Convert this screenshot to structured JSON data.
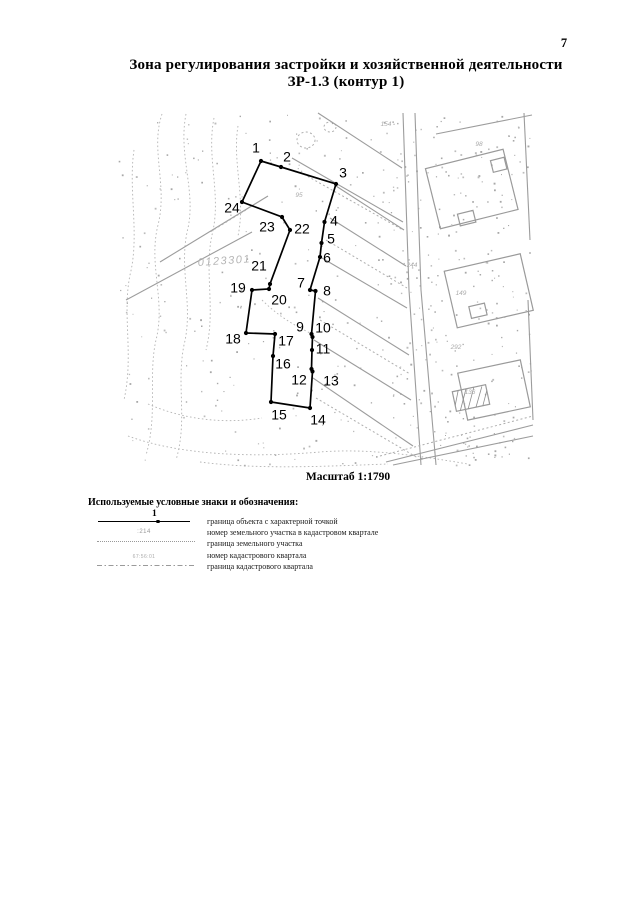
{
  "page": {
    "number": "7"
  },
  "title": {
    "line1": "Зона регулирования застройки и хозяйственной деятельности",
    "line2": "ЗР-1.3 (контур 1)"
  },
  "map": {
    "scale_caption": "Масштаб 1:1790",
    "cadastral_quarter_label": "0123301",
    "boundary_color": "#000000",
    "detail_color": "#a8a8a8",
    "points": [
      {
        "n": "1",
        "x": 261,
        "y": 161,
        "lx": 256,
        "ly": 148
      },
      {
        "n": "2",
        "x": 281,
        "y": 167,
        "lx": 287,
        "ly": 157
      },
      {
        "n": "3",
        "x": 336,
        "y": 184,
        "lx": 343,
        "ly": 173
      },
      {
        "n": "4",
        "x": 324.5,
        "y": 222,
        "lx": 334,
        "ly": 221
      },
      {
        "n": "5",
        "x": 321.5,
        "y": 243,
        "lx": 331,
        "ly": 239
      },
      {
        "n": "6",
        "x": 320,
        "y": 257,
        "lx": 327,
        "ly": 258
      },
      {
        "n": "7",
        "x": 310,
        "y": 290,
        "lx": 301,
        "ly": 283
      },
      {
        "n": "8",
        "x": 315.5,
        "y": 291,
        "lx": 327,
        "ly": 291
      },
      {
        "n": "9",
        "x": 311.5,
        "y": 334,
        "lx": 300,
        "ly": 327
      },
      {
        "n": "10",
        "x": 312.5,
        "y": 337,
        "lx": 323,
        "ly": 328
      },
      {
        "n": "11",
        "x": 312,
        "y": 350,
        "lx": 323,
        "ly": 349
      },
      {
        "n": "12",
        "x": 311.5,
        "y": 369,
        "lx": 299,
        "ly": 380
      },
      {
        "n": "13",
        "x": 312.5,
        "y": 371.5,
        "lx": 331,
        "ly": 381
      },
      {
        "n": "14",
        "x": 310,
        "y": 408,
        "lx": 318,
        "ly": 420
      },
      {
        "n": "15",
        "x": 271,
        "y": 402,
        "lx": 279,
        "ly": 415
      },
      {
        "n": "16",
        "x": 273,
        "y": 356,
        "lx": 283,
        "ly": 364
      },
      {
        "n": "17",
        "x": 275,
        "y": 334,
        "lx": 286,
        "ly": 341
      },
      {
        "n": "18",
        "x": 246,
        "y": 333,
        "lx": 233,
        "ly": 339
      },
      {
        "n": "19",
        "x": 252,
        "y": 290,
        "lx": 238,
        "ly": 288
      },
      {
        "n": "20",
        "x": 269,
        "y": 289,
        "lx": 279,
        "ly": 300
      },
      {
        "n": "21",
        "x": 270,
        "y": 284,
        "lx": 259,
        "ly": 266
      },
      {
        "n": "22",
        "x": 290,
        "y": 230,
        "lx": 302,
        "ly": 229
      },
      {
        "n": "23",
        "x": 282,
        "y": 217,
        "lx": 267,
        "ly": 227
      },
      {
        "n": "24",
        "x": 242,
        "y": 202,
        "lx": 232,
        "ly": 208
      }
    ],
    "parcel_numbers": [
      {
        "text": "154",
        "x": 386,
        "y": 126
      },
      {
        "text": "98",
        "x": 479,
        "y": 146
      },
      {
        "text": "95",
        "x": 299,
        "y": 197
      },
      {
        "text": "244",
        "x": 412,
        "y": 267
      },
      {
        "text": "149",
        "x": 461,
        "y": 295
      },
      {
        "text": "292",
        "x": 456,
        "y": 349
      },
      {
        "text": "136",
        "x": 470,
        "y": 394
      }
    ]
  },
  "legend": {
    "header": "Используемые условные знаки и обозначения:",
    "items": [
      {
        "symbol": "object-boundary-with-point",
        "sample": "1",
        "label": "граница объекта с характерной точкой"
      },
      {
        "symbol": "parcel-number",
        "sample": ":214",
        "label": "номер земельного участка в кадастровом квартале"
      },
      {
        "symbol": "parcel-boundary",
        "sample": "",
        "label": "граница земельного участка"
      },
      {
        "symbol": "quarter-number",
        "sample": "67:56:01",
        "label": "номер кадастрового квартала"
      },
      {
        "symbol": "quarter-boundary",
        "sample": "",
        "label": "граница кадастрового квартала"
      }
    ]
  }
}
